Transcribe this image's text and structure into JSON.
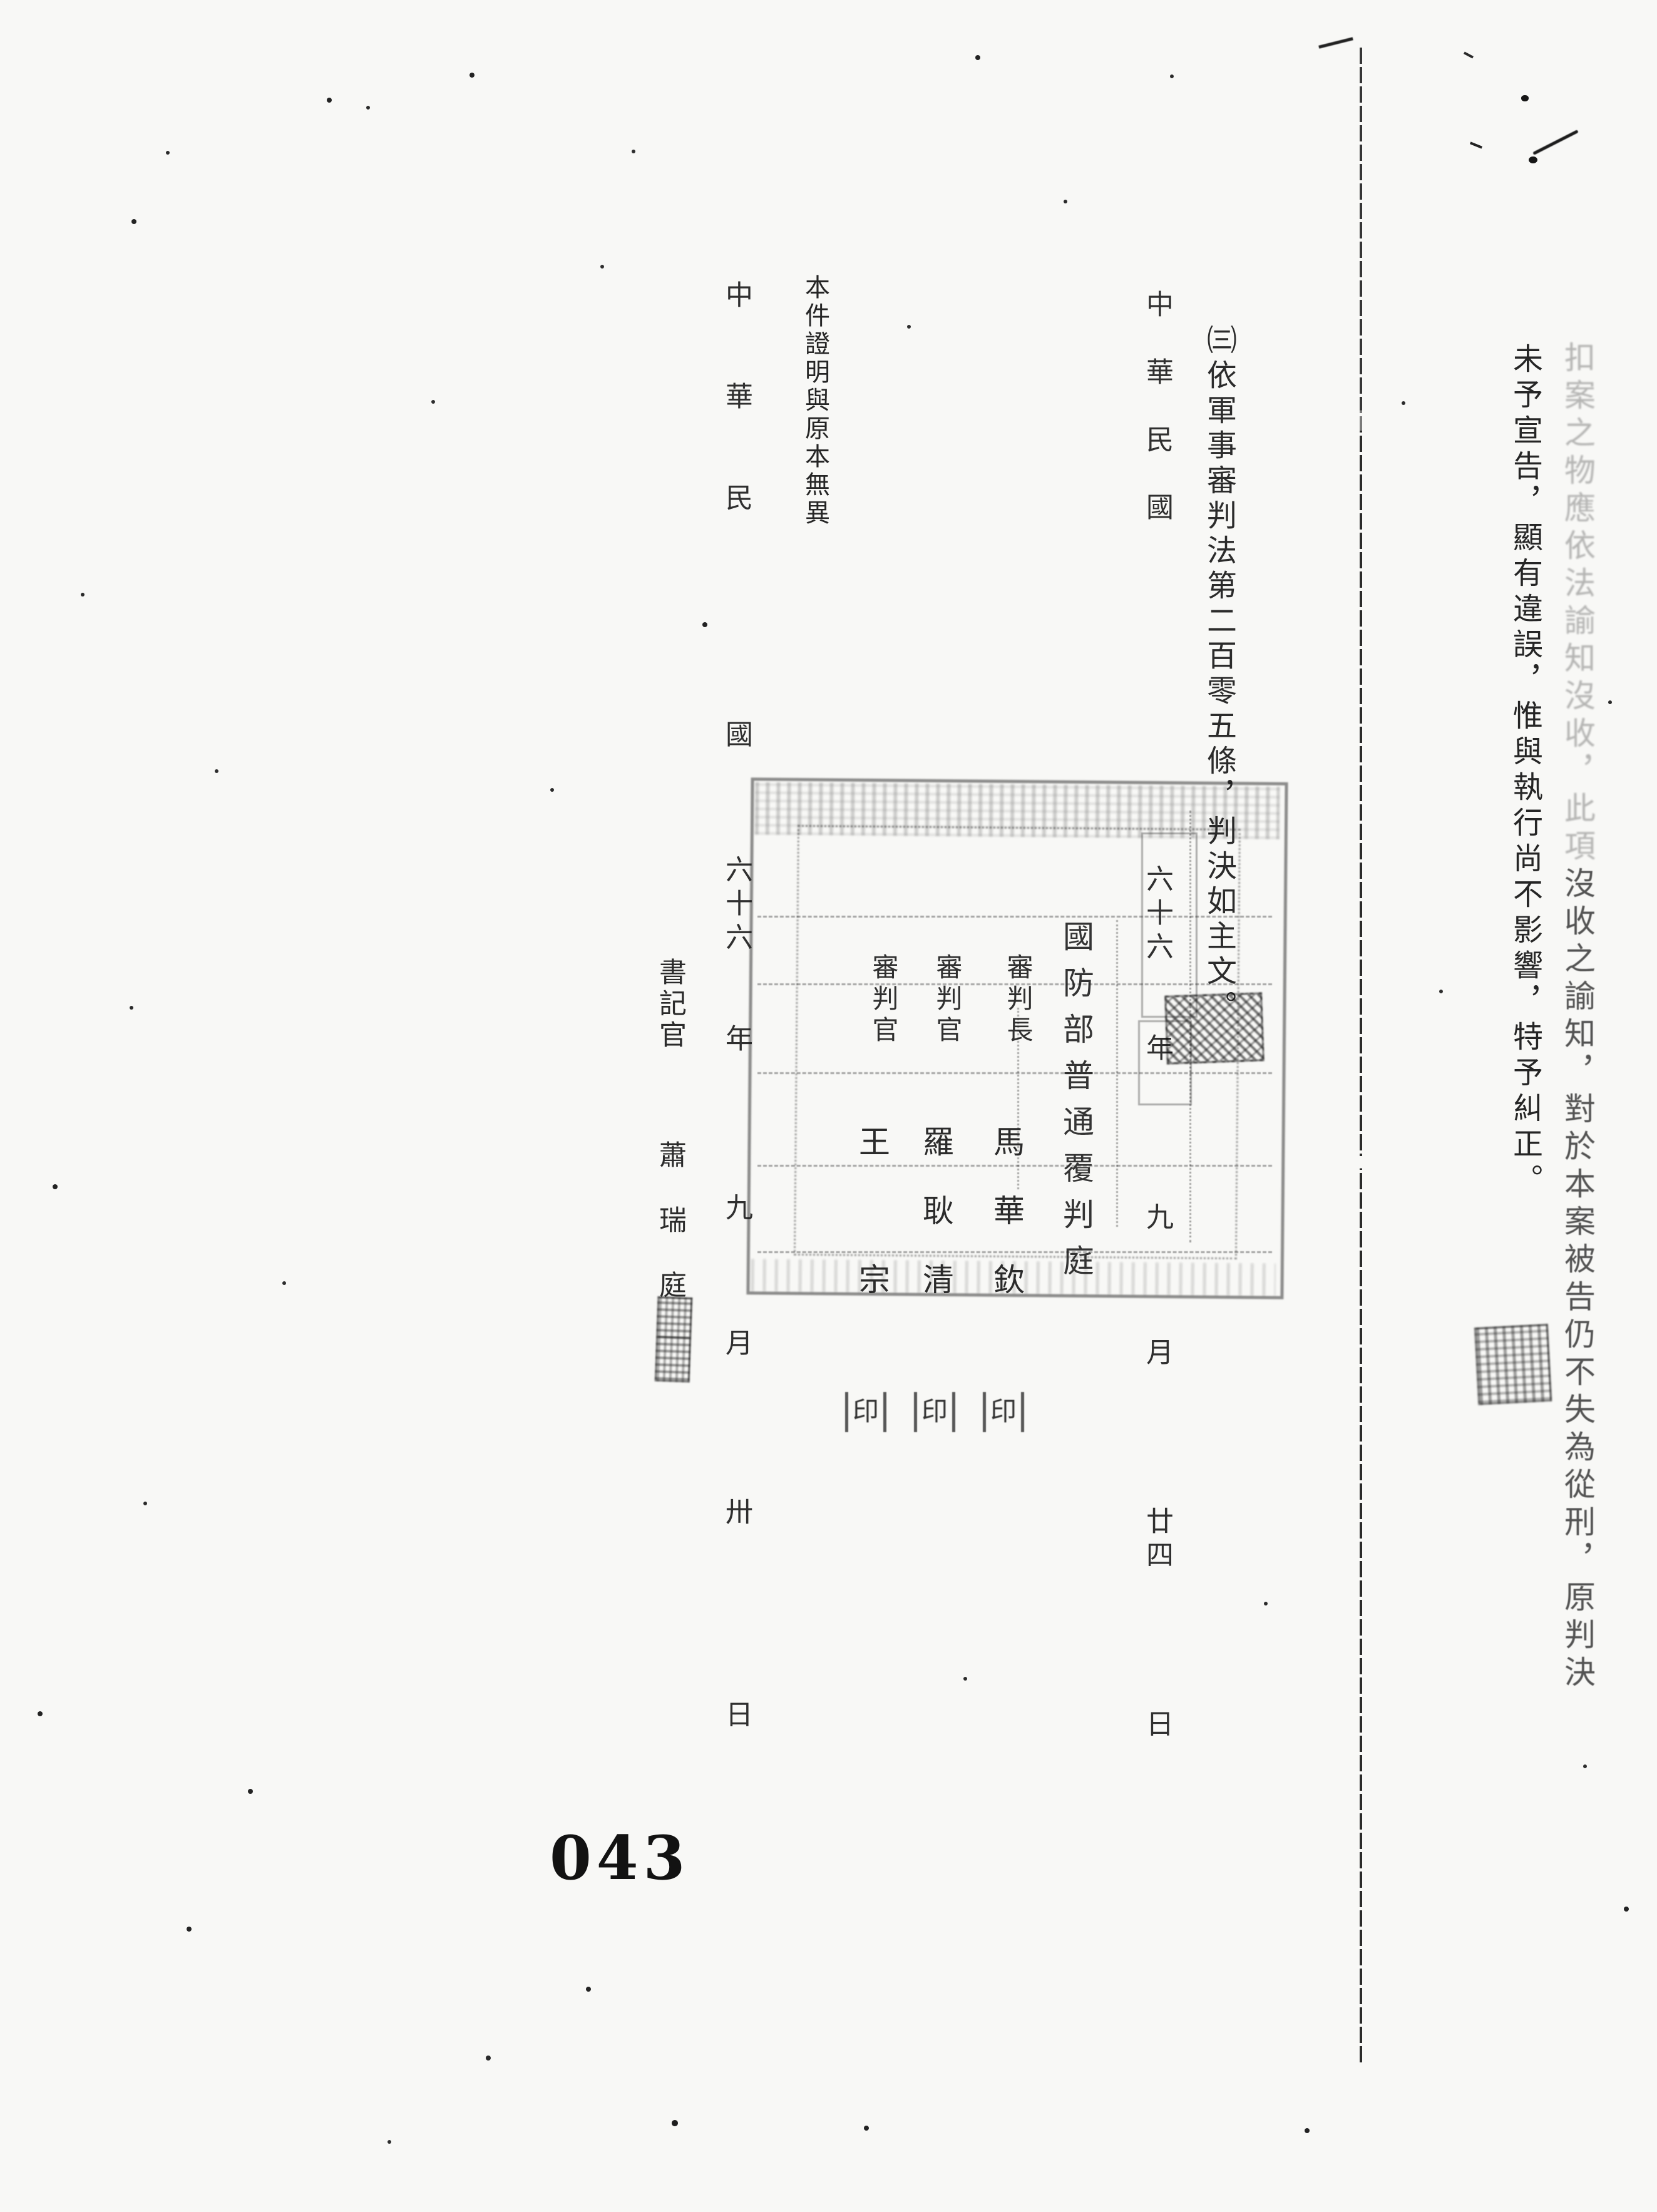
{
  "page": {
    "number": "043",
    "ink_color": "#1a1a1a",
    "paper_color": "#f8f8f6"
  },
  "judgment": {
    "ruling_line_faded": "扣案之物應依法諭知沒收，此項",
    "ruling_line_rest": "沒收之諭知，對於本案被告仍不失為從刑，原判決",
    "correction_line": "未予宣告，顯有違誤，惟與執行尚不影響，特予糾正。",
    "clause_line": "㈢依軍事審判法第二百零五條，判決如主文。",
    "date_line": "中　華　民　國　　　　　　　　　　六十六　　年　　　　九　　　月　　　　廿四　　　　日"
  },
  "panel": {
    "court": "國防部普通覆判庭",
    "judges": [
      {
        "role": "審判長",
        "name": "馬華欽"
      },
      {
        "role": "審判官",
        "name": "羅耿清"
      },
      {
        "role": "審判官",
        "name": "王　宗"
      }
    ],
    "seal_char": "印"
  },
  "certification": {
    "statement": "本件證明與原本無異",
    "date_line": "中　　華　　民　　　　　　國　　　六十六　　年　　　　九　　　月　　　　卅　　　　　日",
    "clerk_title": "書記官",
    "clerk_name": "蕭瑞庭"
  }
}
